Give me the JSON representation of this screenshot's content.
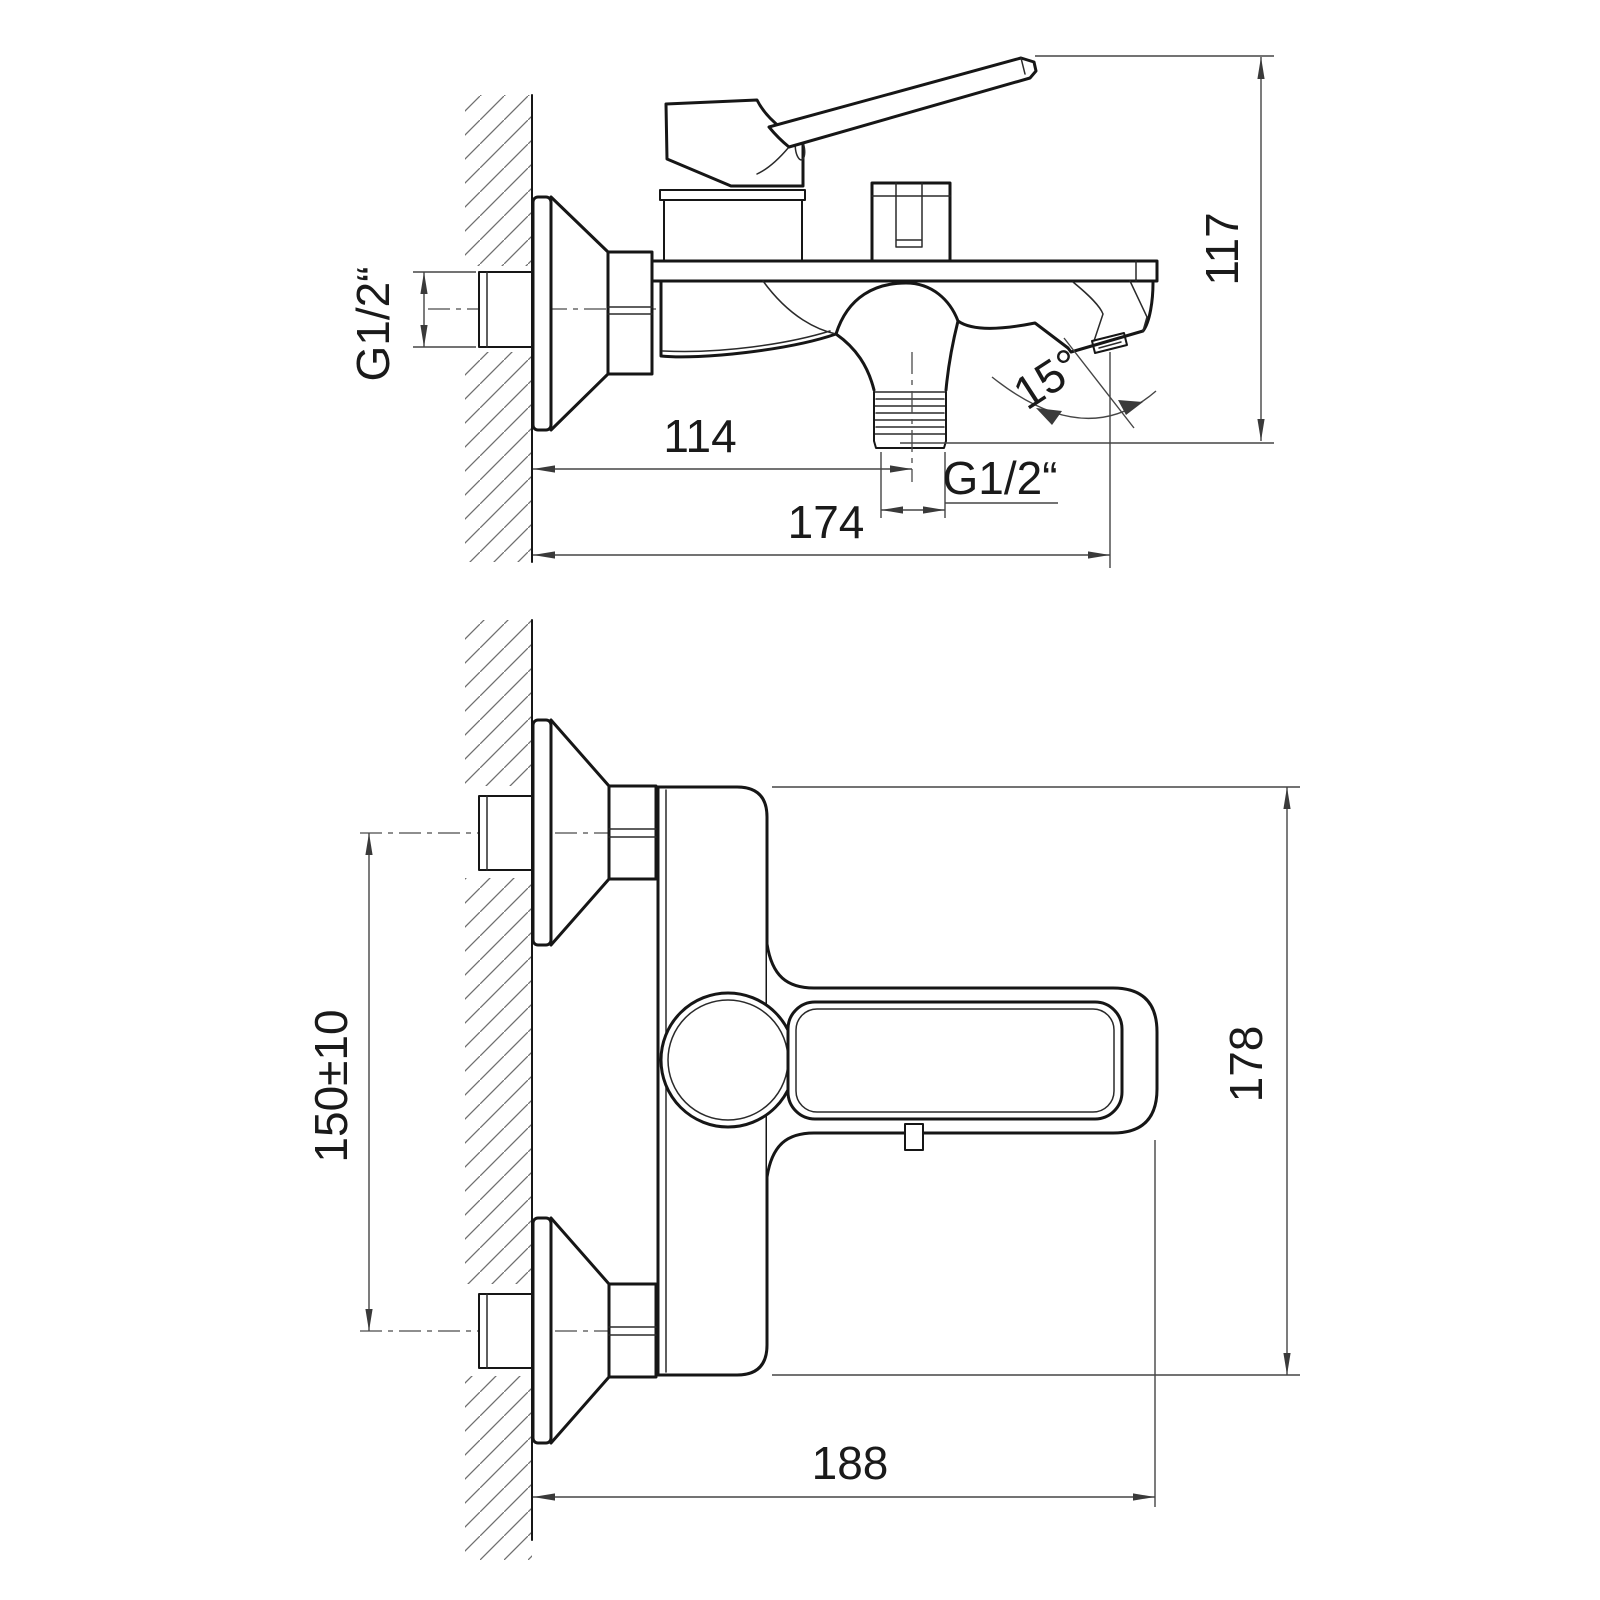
{
  "drawing": {
    "kind": "technical installation drawing, wall-mounted bath mixer tap, two orthographic views",
    "background_color": "#ffffff",
    "outline_color": "#161616",
    "dimension_color": "#454545"
  },
  "dimensions": {
    "side_view": {
      "wall_connection_thread": "G1/2“",
      "wall_to_shower_outlet": "114",
      "shower_outlet_thread": "G1/2“",
      "total_projection": "174",
      "handle_to_outlet_height": "117",
      "spout_angle": "15°"
    },
    "front_view": {
      "connection_centers_spacing": "150±10",
      "overall_height": "178",
      "overall_width_from_wall": "188"
    }
  }
}
